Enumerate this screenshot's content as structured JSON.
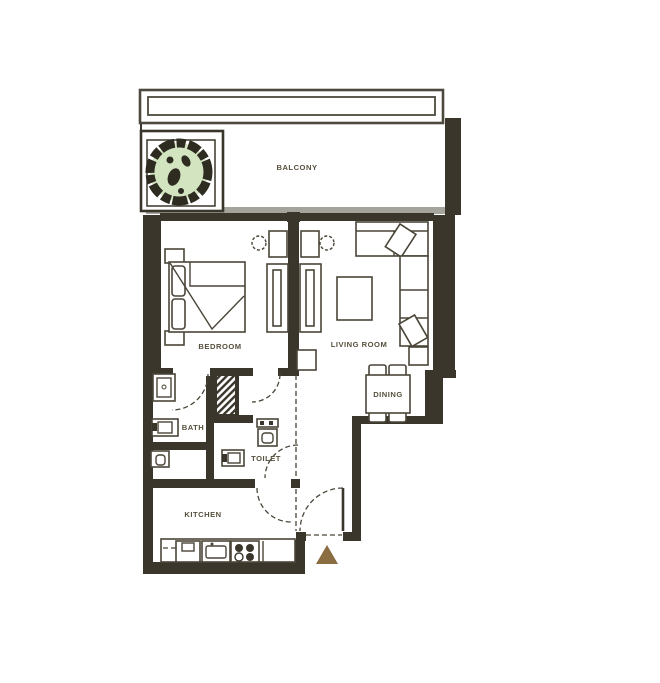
{
  "rooms": {
    "balcony": "BALCONY",
    "bedroom": "BEDROOM",
    "living_room": "LIVING ROOM",
    "dining": "DINING",
    "bath": "BATH",
    "toilet": "TOILET",
    "kitchen": "KITCHEN"
  },
  "colors": {
    "wall": "#3a362b",
    "furniture_line": "#4a4538",
    "label_text": "#57503e",
    "tree_canopy_fill": "#d3e5c0",
    "tree_dark": "#2e2b21",
    "balcony_slab": "#a4a49c",
    "entry_arrow": "#8a6d40",
    "background": "#ffffff"
  },
  "markers": {
    "entry_arrow": "entry-direction"
  }
}
